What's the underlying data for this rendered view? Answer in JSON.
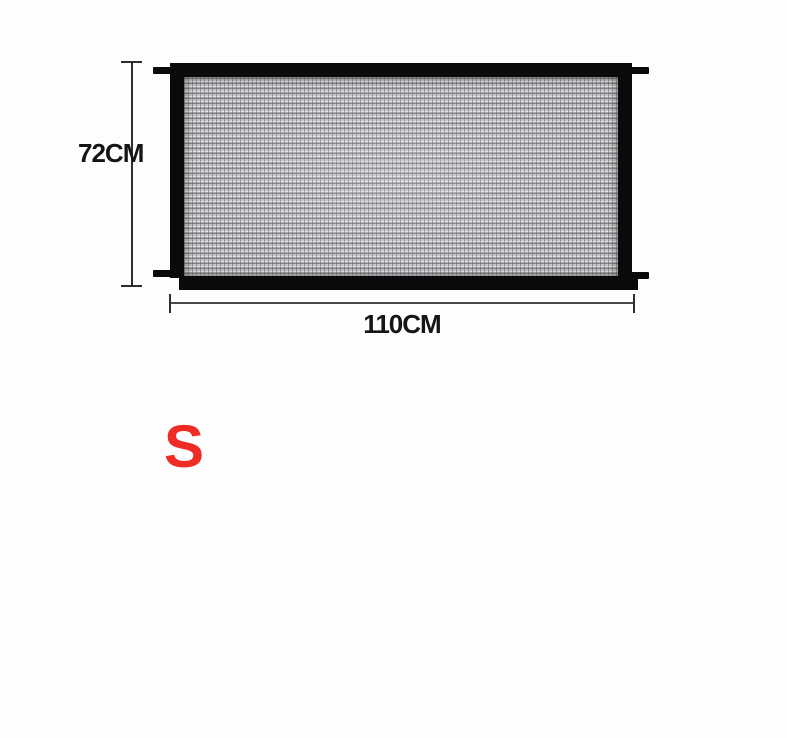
{
  "product_diagram": {
    "item": "mesh-safety-gate",
    "height_dimension": "72CM",
    "width_dimension": "110CM",
    "size_option": "S"
  },
  "colors": {
    "background": "#fdfdfd",
    "frame": "#0a0a0a",
    "mesh-base": "#b2b2b6",
    "dimension": "#2e2e2e",
    "size-red": "#ee2b25"
  }
}
